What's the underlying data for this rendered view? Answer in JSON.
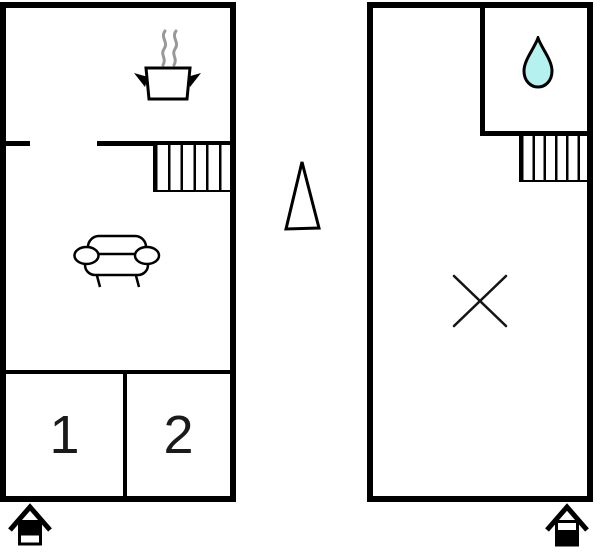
{
  "floorplan": {
    "upper_floor": {
      "level_indicator": "upper-half-filled-house",
      "rooms": [
        {
          "label": "1"
        },
        {
          "label": "2"
        }
      ],
      "features": [
        "cooking-pot",
        "steam",
        "sofa",
        "staircase",
        "door-opening"
      ]
    },
    "ground_floor": {
      "level_indicator": "lower-half-filled-house",
      "features": [
        "water-drop",
        "staircase",
        "x-mark"
      ]
    },
    "compass": {
      "shape": "triangle-arrow-up"
    },
    "colors": {
      "wall": "#000000",
      "steam": "#999999",
      "water_drop": "#b5f1ee",
      "x_mark": "#151515",
      "background": "#ffffff"
    }
  }
}
